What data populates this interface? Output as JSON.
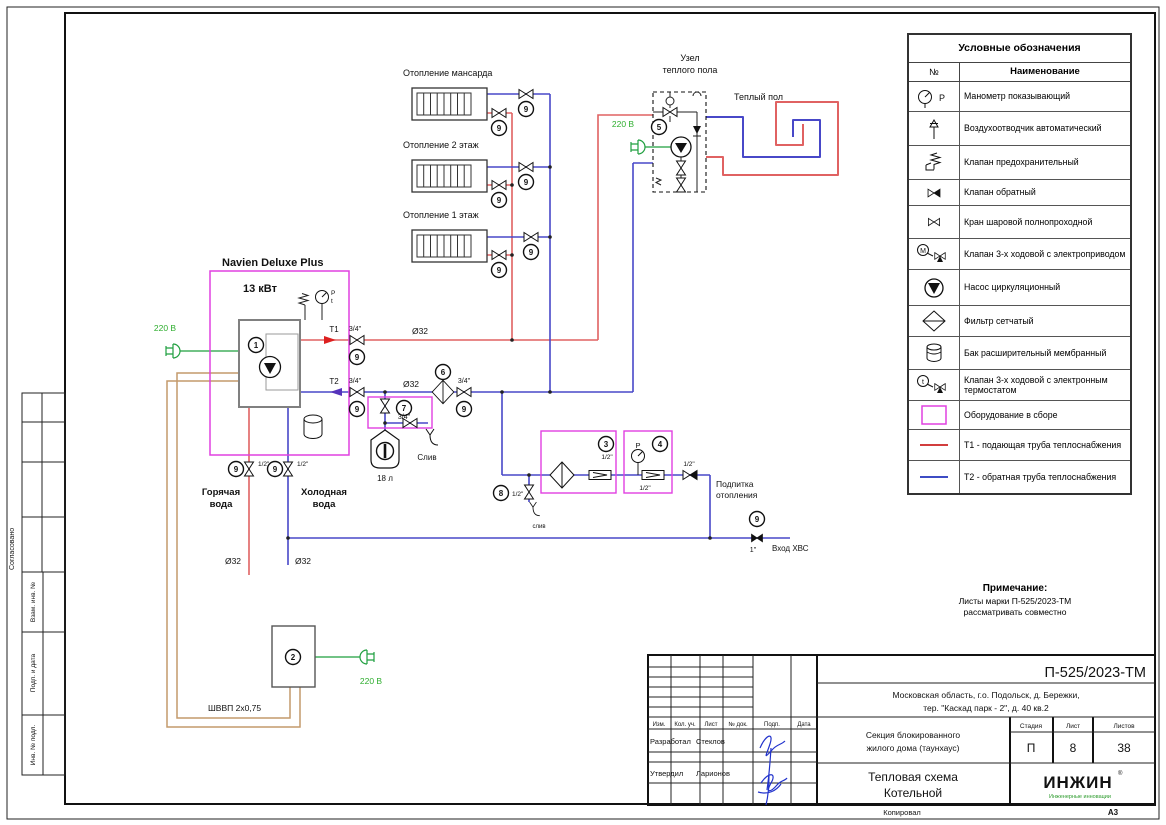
{
  "page": {
    "format": "А3",
    "copied_label": "Копировал"
  },
  "colors": {
    "t1_red": "#e06262",
    "t2_blue": "#4848c8",
    "magenta": "#e040e0",
    "power_green": "#1f9f3f",
    "cable_brown": "#c49a6c",
    "signature_blue": "#2233cc",
    "text_green": "#2fae2f"
  },
  "left_margin": {
    "approved": "Согласовано",
    "box1": "Взам. инв. №",
    "box2": "Подп. и дата",
    "box3": "Инв. № подл."
  },
  "legend": {
    "title": "Условные обозначения",
    "col_no": "№",
    "col_name": "Наименование",
    "rows": [
      {
        "icon": "gauge",
        "icon_label": "P",
        "name": "Манометр показывающий"
      },
      {
        "icon": "airvent",
        "name": "Воздухоотводчик автоматический"
      },
      {
        "icon": "safety",
        "name": "Клапан предохранительный"
      },
      {
        "icon": "check",
        "name": "Клапан обратный"
      },
      {
        "icon": "ball",
        "name": "Кран шаровой полнопроходной"
      },
      {
        "icon": "way3m",
        "icon_label": "М",
        "name": "Клапан 3-х ходовой с электроприводом"
      },
      {
        "icon": "pump",
        "name": "Насос циркуляционный"
      },
      {
        "icon": "filter",
        "name": "Фильтр сетчатый"
      },
      {
        "icon": "tank",
        "name": "Бак расширительный мембранный"
      },
      {
        "icon": "way3t",
        "icon_label": "t",
        "name": "Клапан 3-х ходовой с электронным термостатом"
      },
      {
        "icon": "assembly",
        "name": "Оборудование в сборе"
      },
      {
        "icon": "line_red",
        "name": "Т1 - подающая труба теплоснабжения"
      },
      {
        "icon": "line_blue",
        "name": "Т2 - обратная труба теплоснабжения"
      }
    ]
  },
  "note": {
    "title": "Примечание:",
    "line1": "Листы марки П-525/2023-ТМ",
    "line2": "рассматривать совместно"
  },
  "title_block": {
    "doc_code": "П-525/2023-ТМ",
    "address_l1": "Московская область, г.о. Подольск, д. Бережки,",
    "address_l2": "тер. \"Каскад парк - 2\", д. 40 кв.2",
    "object_l1": "Секция блокированного",
    "object_l2": "жилого дома (таунхаус)",
    "stage_h": "Стадия",
    "sheet_h": "Лист",
    "sheets_h": "Листов",
    "stage": "П",
    "sheet": "8",
    "sheets": "38",
    "title_l1": "Тепловая схема",
    "title_l2": "Котельной",
    "col1": "Изм.",
    "col2": "Кол. уч.",
    "col3": "Лист",
    "col4": "№ док.",
    "col5": "Подп.",
    "col6": "Дата",
    "developed_role": "Разработал",
    "developed_name": "Стеклов",
    "approved_role": "Утвердил",
    "approved_name": "Ларионов",
    "logo_text": "ИНЖИН",
    "logo_r": "®",
    "logo_sub": "Инженерные инновации"
  },
  "tags": {
    "n1": "1",
    "n2": "2",
    "n3": "3",
    "n4": "4",
    "n5": "5",
    "n6": "6",
    "n7": "7",
    "n8": "8",
    "n9": "9"
  },
  "diagram": {
    "labels": {
      "boiler_name": "Navien Deluxe Plus",
      "boiler_power": "13 кВт",
      "heat_attic": "Отопление мансарда",
      "heat_fl2": "Отопление 2 этаж",
      "heat_fl1": "Отопление 1 этаж",
      "unit_l1": "Узел",
      "unit_l2": "теплого пола",
      "warm_floor": "Теплый пол",
      "v220": "220 В",
      "t1": "T1",
      "t2": "T2",
      "d32": "Ø32",
      "d34": "3/4\"",
      "d12": "1/2\"",
      "d1": "1\"",
      "p": "P",
      "t": "t",
      "hot_l1": "Горячая",
      "hot_l2": "вода",
      "cold_l1": "Холодная",
      "cold_l2": "вода",
      "drain_cap": "Слив",
      "drain_small": "слив",
      "tank_vol": "18 л",
      "cable": "ШВВП 2х0,75",
      "makeup_l1": "Подпитка",
      "makeup_l2": "отопления",
      "hvs_in": "Вход ХВС"
    }
  }
}
